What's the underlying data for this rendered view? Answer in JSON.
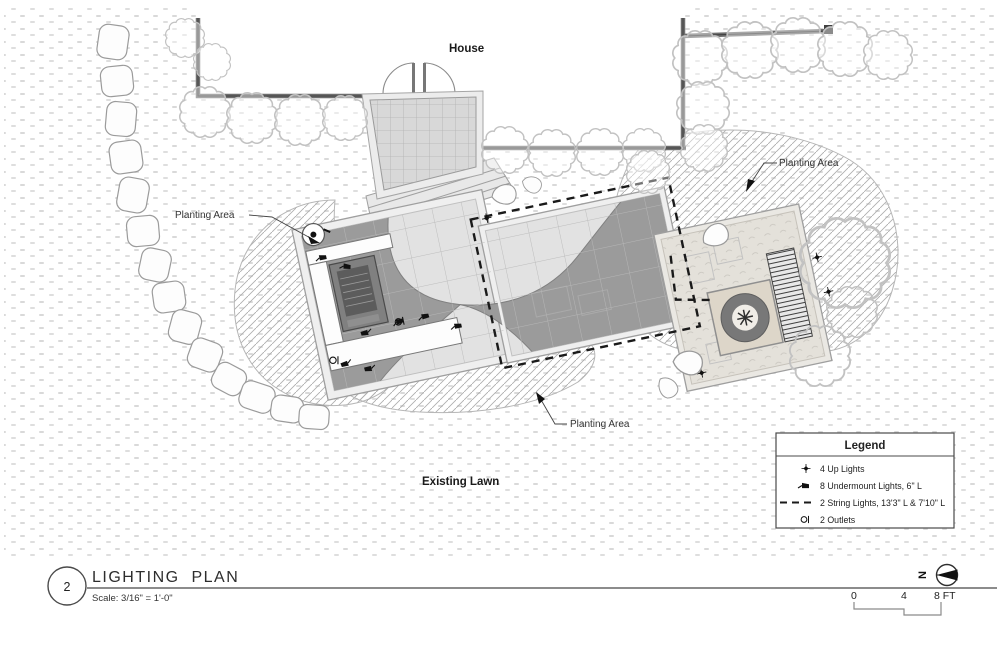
{
  "title_block": {
    "number": "2",
    "title": "LIGHTING  PLAN",
    "scale": "Scale: 3/16\" = 1'-0\""
  },
  "labels": {
    "house": "House",
    "planting_area": "Planting Area",
    "existing_lawn": "Existing Lawn"
  },
  "legend": {
    "title": "Legend",
    "items": [
      {
        "icon": "up-light-icon",
        "label": "4 Up Lights"
      },
      {
        "icon": "undermount-light-icon",
        "label": "8 Undermount Lights, 6\" L"
      },
      {
        "icon": "string-light-icon",
        "label": "2 String Lights, 13'3\" L & 7'10\" L"
      },
      {
        "icon": "outlet-icon",
        "label": "2 Outlets"
      }
    ]
  },
  "north_arrow": {
    "label": "N"
  },
  "scale_bar": {
    "ticks": [
      "0",
      "4",
      "8 FT"
    ]
  },
  "colors": {
    "paving_dark": "#9b9b9b",
    "paving_light": "#ececec",
    "deck_gray": "#d8d8d8",
    "wall_gray": "#6e6e6e",
    "hatch_gray": "#b0b0b0",
    "line_black": "#111111"
  }
}
